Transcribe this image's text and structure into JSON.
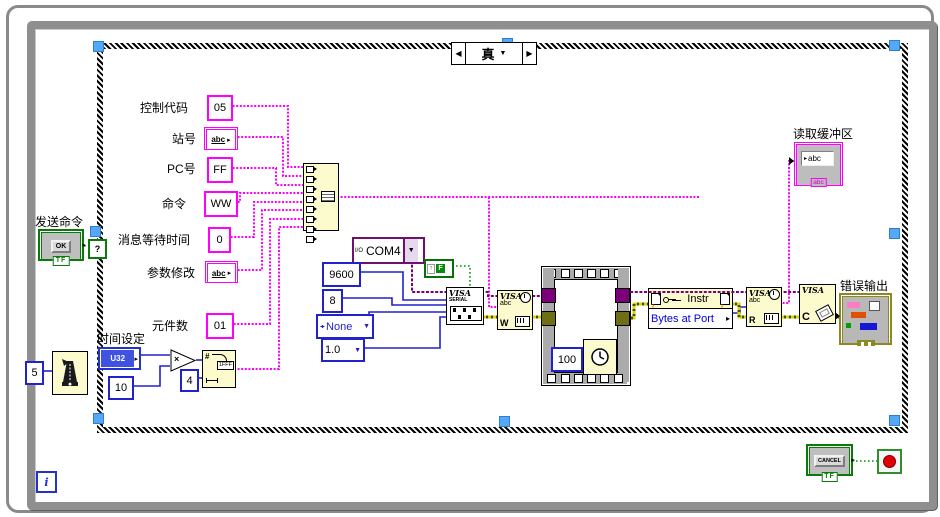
{
  "glyphs": {
    "caret": "▼",
    "prev": "◀",
    "next": "▶",
    "out_arrow": "▸",
    "in_arrow": "▷",
    "question": "?",
    "badge": "?!"
  },
  "case_selector": {
    "value": "真"
  },
  "send_command": {
    "label": "发送命令",
    "button_text": "OK",
    "boolean_tag": "TF"
  },
  "string_inputs": {
    "control_code": {
      "label": "控制代码",
      "value": "05"
    },
    "station_no": {
      "label": "站号",
      "value": "abc"
    },
    "pc_no": {
      "label": "PC号",
      "value": "FF"
    },
    "command": {
      "label": "命令",
      "value": "WW"
    },
    "message_wait_time": {
      "label": "消息等待时间",
      "value": "0"
    },
    "param_modify": {
      "label": "参数修改",
      "value": "abc"
    },
    "element_count": {
      "label": "元件数",
      "value": "01"
    }
  },
  "time_setting": {
    "label": "时间设定",
    "type_tag": "U32",
    "multiplier": "10",
    "multiply_glyph": "×",
    "hex_width": "4",
    "hex_hash": "#",
    "hex_sample": "1FFF"
  },
  "wait_next_ms": {
    "value": "5"
  },
  "serial_config": {
    "resource": "COM4",
    "io_glyph": "I/O",
    "baud_rate": "9600",
    "data_bits": "8",
    "parity": "None",
    "stop_bits": "1.0",
    "flow_false": "F",
    "enum_glyph": "◂▸"
  },
  "visa_nodes": {
    "brand": "VISA",
    "serial_tag": "SERIAL",
    "abc": "abc",
    "write_letter": "W",
    "read_letter": "R",
    "close_letter": "C"
  },
  "sequence": {
    "delay_ms": "100"
  },
  "property_node": {
    "class_name": "Instr",
    "property": "Bytes at Port"
  },
  "read_buffer": {
    "label": "读取缓冲区",
    "value": "abc",
    "tag": "abc"
  },
  "error_output": {
    "label": "错误输出"
  },
  "while_loop": {
    "iteration": "i"
  },
  "cancel": {
    "button_text": "CANCEL",
    "boolean_tag": "TF"
  }
}
